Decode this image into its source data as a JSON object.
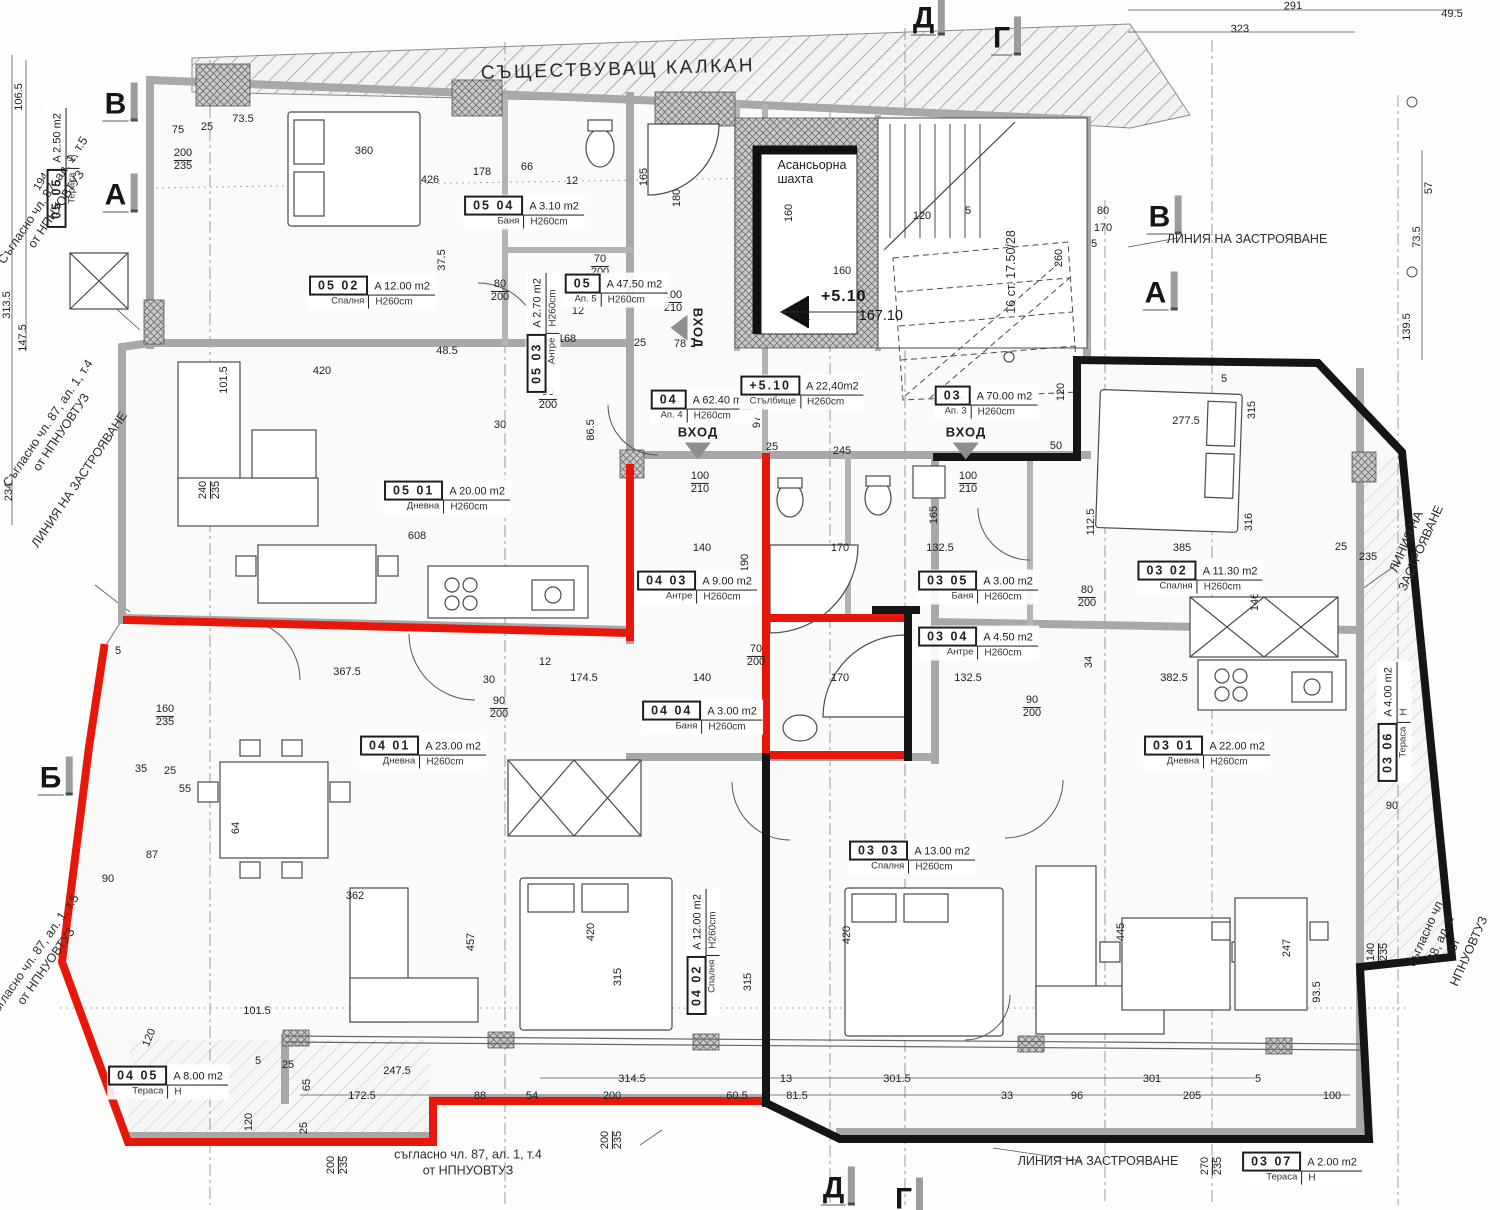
{
  "title": "СЪЩЕСТВУВАЩ КАЛКАН",
  "elevator": {
    "label": "Асансьорна\nшахта"
  },
  "level_marker": {
    "value": "+5.10",
    "kk": "КК",
    "elev": "167.10"
  },
  "colors": {
    "boundary_red": "#e8170c",
    "boundary_black": "#151515",
    "wall_gray": "#a8a8a8"
  },
  "rooms": [
    {
      "id": "05 05",
      "a": "A 2.50 m2",
      "n": "Тераса",
      "h": "Н",
      "x": 63,
      "y": 168,
      "r": -90
    },
    {
      "id": "05 02",
      "a": "A 12.00 m2",
      "n": "Спалня",
      "h": "H260cm",
      "x": 372,
      "y": 292
    },
    {
      "id": "05 04",
      "a": "A 3.10 m2",
      "n": "Баня",
      "h": "H260cm",
      "x": 524,
      "y": 212
    },
    {
      "id": "05 03",
      "a": "A 2.70 m2",
      "n": "Антре",
      "h": "H260cm",
      "x": 543,
      "y": 333,
      "r": -90
    },
    {
      "id": "05",
      "a": "A 47.50 m2",
      "n": "Ап. 5",
      "h": "H260cm",
      "x": 616,
      "y": 290
    },
    {
      "id": "05 01",
      "a": "A 20.00 m2",
      "n": "Дневна",
      "h": "H260cm",
      "x": 447,
      "y": 497
    },
    {
      "id": "04",
      "a": "A 62.40 m2",
      "n": "Ап. 4",
      "h": "H260cm",
      "x": 702,
      "y": 406
    },
    {
      "id": "+5.10",
      "a": "A 22,40m2",
      "n": "Стълбище",
      "h": "H260cm",
      "x": 802,
      "y": 392
    },
    {
      "id": "03",
      "a": "A 70.00 m2",
      "n": "Ап. 3",
      "h": "H260cm",
      "x": 986,
      "y": 402
    },
    {
      "id": "04 03",
      "a": "A 9.00 m2",
      "n": "Антре",
      "h": "H260cm",
      "x": 697,
      "y": 587
    },
    {
      "id": "03 05",
      "a": "A 3.00 m2",
      "n": "Баня",
      "h": "H260cm",
      "x": 978,
      "y": 587
    },
    {
      "id": "03 04",
      "a": "A 4.50 m2",
      "n": "Антре",
      "h": "H260cm",
      "x": 978,
      "y": 643
    },
    {
      "id": "03 02",
      "a": "A 11.30 m2",
      "n": "Спалня",
      "h": "H260cm",
      "x": 1200,
      "y": 577
    },
    {
      "id": "04 01",
      "a": "A 23.00 m2",
      "n": "Дневна",
      "h": "H260cm",
      "x": 423,
      "y": 752
    },
    {
      "id": "04 04",
      "a": "A 3.00 m2",
      "n": "Баня",
      "h": "H260cm",
      "x": 702,
      "y": 717
    },
    {
      "id": "03 01",
      "a": "A 22.00 m2",
      "n": "Дневна",
      "h": "H260cm",
      "x": 1207,
      "y": 752
    },
    {
      "id": "03 06",
      "a": "A 4.00 m2",
      "n": "Тераса",
      "h": "Н",
      "x": 1394,
      "y": 722,
      "r": -90
    },
    {
      "id": "03 03",
      "a": "A 13.00 m2",
      "n": "Спалня",
      "h": "H260cm",
      "x": 912,
      "y": 857
    },
    {
      "id": "04 02",
      "a": "A 12.00 m2",
      "n": "Спалня",
      "h": "H260cm",
      "x": 703,
      "y": 952,
      "r": -90
    },
    {
      "id": "04 05",
      "a": "A 8.00 m2",
      "n": "Тераса",
      "h": "Н",
      "x": 168,
      "y": 1082
    },
    {
      "id": "03 07",
      "a": "A 2.00 m2",
      "n": "Тераса",
      "h": "Н",
      "x": 1302,
      "y": 1168
    }
  ],
  "annotations": [
    {
      "t": "ЛИНИЯ НА ЗАСТРОЯВАНЕ",
      "x": 1247,
      "y": 240
    },
    {
      "t": "ЛИНИЯ НА ЗАСТРОЯВАНЕ",
      "x": 80,
      "y": 480,
      "r": -56
    },
    {
      "t": "ЛИНИЯ НА ЗАСТРОЯВАНЕ",
      "x": 1414,
      "y": 545,
      "r": -66
    },
    {
      "t": "ЛИНИЯ НА ЗАСТРОЯВАНЕ",
      "x": 1098,
      "y": 1162
    },
    {
      "t": "Съгласно чл. 87, ал. 1, т.5\nот НПНУОВТУЗ",
      "x": 50,
      "y": 205,
      "r": -56
    },
    {
      "t": "Съгласно чл. 87, ал. 1, т.4\nот НПНУОВТУЗ",
      "x": 55,
      "y": 428,
      "r": -56
    },
    {
      "t": "Съгласно чл. 87, ал. 1, т.5\nот НПНУОВТУЗ",
      "x": 40,
      "y": 962,
      "r": -55
    },
    {
      "t": "съгласно чл. 87, ал. 1, т.4\nот НПНУОВТУЗ",
      "x": 468,
      "y": 1163
    },
    {
      "t": "съгласно чл. 88, ал. 2\nот НПНУОВТУЗ",
      "x": 1448,
      "y": 942,
      "r": -66
    },
    {
      "t": "16 ст. 17.50/28",
      "x": 1012,
      "y": 272,
      "r": -90
    }
  ],
  "grid_markers": [
    {
      "l": "В",
      "x": 120,
      "y": 102
    },
    {
      "l": "А",
      "x": 120,
      "y": 193
    },
    {
      "l": "Б",
      "x": 55,
      "y": 776
    },
    {
      "l": "В",
      "x": 1164,
      "y": 215
    },
    {
      "l": "А",
      "x": 1160,
      "y": 291
    },
    {
      "l": "Д",
      "x": 928,
      "y": 16
    },
    {
      "l": "Г",
      "x": 1006,
      "y": 36
    },
    {
      "l": "Д",
      "x": 838,
      "y": 1186
    },
    {
      "l": "Г",
      "x": 908,
      "y": 1197
    }
  ],
  "entrances": [
    {
      "label": "ВХОД",
      "x": 698,
      "y": 442
    },
    {
      "label": "ВХОД",
      "x": 966,
      "y": 442
    },
    {
      "label": "ВХОД",
      "x": 688,
      "y": 328,
      "r": 90
    }
  ],
  "dimensions": [
    {
      "x": 1293,
      "y": 7,
      "t": "291",
      "r": -2
    },
    {
      "x": 1452,
      "y": 15,
      "t": "49.5"
    },
    {
      "x": 1240,
      "y": 30,
      "t": "323",
      "r": -2
    },
    {
      "x": 20,
      "y": 97,
      "t": "106.5",
      "r": -90
    },
    {
      "x": 8,
      "y": 305,
      "t": "313.5",
      "r": -90
    },
    {
      "x": 24,
      "y": 338,
      "t": "147.5",
      "r": -90
    },
    {
      "x": 10,
      "y": 492,
      "t": "234",
      "r": -90
    },
    {
      "x": 42,
      "y": 182,
      "t": "194",
      "r": -58
    },
    {
      "x": 1418,
      "y": 237,
      "t": "73.5",
      "r": -90
    },
    {
      "x": 1430,
      "y": 188,
      "t": "57",
      "r": -90
    },
    {
      "x": 1408,
      "y": 327,
      "t": "139.5",
      "r": -90
    },
    {
      "x": 178,
      "y": 131,
      "t": "75"
    },
    {
      "x": 207,
      "y": 128,
      "t": "25"
    },
    {
      "x": 243,
      "y": 120,
      "t": "73.5"
    },
    {
      "x": 183,
      "y": 160,
      "t": "200",
      "t2": "235"
    },
    {
      "x": 364,
      "y": 152,
      "t": "360"
    },
    {
      "x": 430,
      "y": 181,
      "t": "426"
    },
    {
      "x": 482,
      "y": 173,
      "t": "178"
    },
    {
      "x": 527,
      "y": 168,
      "t": "66"
    },
    {
      "x": 572,
      "y": 182,
      "t": "12"
    },
    {
      "x": 645,
      "y": 177,
      "t": "165",
      "r": -90
    },
    {
      "x": 678,
      "y": 198,
      "t": "180",
      "r": -90
    },
    {
      "x": 790,
      "y": 213,
      "t": "160",
      "r": -90
    },
    {
      "x": 922,
      "y": 217,
      "t": "120"
    },
    {
      "x": 968,
      "y": 212,
      "t": "5"
    },
    {
      "x": 1103,
      "y": 212,
      "t": "80"
    },
    {
      "x": 1103,
      "y": 229,
      "t": "170"
    },
    {
      "x": 1094,
      "y": 245,
      "t": "5"
    },
    {
      "x": 443,
      "y": 260,
      "t": "37.5",
      "r": -90
    },
    {
      "x": 447,
      "y": 352,
      "t": "48.5"
    },
    {
      "x": 500,
      "y": 291,
      "t": "80",
      "t2": "200"
    },
    {
      "x": 600,
      "y": 266,
      "t": "70",
      "t2": "200"
    },
    {
      "x": 673,
      "y": 302,
      "t": "100",
      "t2": "210"
    },
    {
      "x": 548,
      "y": 399,
      "t": "90",
      "t2": "200"
    },
    {
      "x": 500,
      "y": 426,
      "t": "30"
    },
    {
      "x": 592,
      "y": 430,
      "t": "86.5",
      "r": -90
    },
    {
      "x": 567,
      "y": 340,
      "t": "168"
    },
    {
      "x": 578,
      "y": 312,
      "t": "12"
    },
    {
      "x": 632,
      "y": 288,
      "t": "35",
      "r": -90
    },
    {
      "x": 640,
      "y": 344,
      "t": "25"
    },
    {
      "x": 680,
      "y": 345,
      "t": "78"
    },
    {
      "x": 700,
      "y": 483,
      "t": "100",
      "t2": "210"
    },
    {
      "x": 758,
      "y": 422,
      "t": "97",
      "r": -90
    },
    {
      "x": 842,
      "y": 272,
      "t": "160"
    },
    {
      "x": 772,
      "y": 448,
      "t": "25"
    },
    {
      "x": 842,
      "y": 452,
      "t": "245"
    },
    {
      "x": 968,
      "y": 483,
      "t": "100",
      "t2": "210"
    },
    {
      "x": 1056,
      "y": 447,
      "t": "50"
    },
    {
      "x": 1062,
      "y": 392,
      "t": "120",
      "r": -90
    },
    {
      "x": 1060,
      "y": 258,
      "t": "260",
      "r": -90
    },
    {
      "x": 1224,
      "y": 380,
      "t": "5"
    },
    {
      "x": 225,
      "y": 380,
      "t": "101.5",
      "r": -90
    },
    {
      "x": 322,
      "y": 372,
      "t": "420"
    },
    {
      "x": 210,
      "y": 490,
      "t": "240",
      "t2": "235",
      "r": -90
    },
    {
      "x": 417,
      "y": 537,
      "t": "608"
    },
    {
      "x": 347,
      "y": 673,
      "t": "367.5"
    },
    {
      "x": 489,
      "y": 681,
      "t": "30"
    },
    {
      "x": 499,
      "y": 708,
      "t": "90",
      "t2": "200"
    },
    {
      "x": 584,
      "y": 679,
      "t": "174.5"
    },
    {
      "x": 545,
      "y": 663,
      "t": "12"
    },
    {
      "x": 702,
      "y": 549,
      "t": "140"
    },
    {
      "x": 746,
      "y": 563,
      "t": "190",
      "r": -90
    },
    {
      "x": 702,
      "y": 679,
      "t": "140"
    },
    {
      "x": 840,
      "y": 549,
      "t": "170"
    },
    {
      "x": 840,
      "y": 679,
      "t": "170"
    },
    {
      "x": 756,
      "y": 656,
      "t": "70",
      "t2": "200"
    },
    {
      "x": 940,
      "y": 549,
      "t": "132.5"
    },
    {
      "x": 968,
      "y": 679,
      "t": "132.5"
    },
    {
      "x": 935,
      "y": 515,
      "t": "165",
      "r": -90
    },
    {
      "x": 1087,
      "y": 597,
      "t": "80",
      "t2": "200"
    },
    {
      "x": 1032,
      "y": 707,
      "t": "90",
      "t2": "200"
    },
    {
      "x": 1092,
      "y": 522,
      "t": "112.5",
      "r": -90
    },
    {
      "x": 1090,
      "y": 662,
      "t": "34",
      "r": -90
    },
    {
      "x": 1182,
      "y": 549,
      "t": "385"
    },
    {
      "x": 1174,
      "y": 679,
      "t": "382.5"
    },
    {
      "x": 1250,
      "y": 522,
      "t": "316",
      "r": -90
    },
    {
      "x": 1256,
      "y": 602,
      "t": "146",
      "r": -90
    },
    {
      "x": 1341,
      "y": 548,
      "t": "25"
    },
    {
      "x": 1368,
      "y": 558,
      "t": "235"
    },
    {
      "x": 1186,
      "y": 422,
      "t": "277.5"
    },
    {
      "x": 1253,
      "y": 410,
      "t": "315",
      "r": -90
    },
    {
      "x": 165,
      "y": 716,
      "t": "160",
      "t2": "235"
    },
    {
      "x": 141,
      "y": 770,
      "t": "35"
    },
    {
      "x": 170,
      "y": 772,
      "t": "25"
    },
    {
      "x": 185,
      "y": 790,
      "t": "55"
    },
    {
      "x": 152,
      "y": 856,
      "t": "87"
    },
    {
      "x": 108,
      "y": 880,
      "t": "90"
    },
    {
      "x": 237,
      "y": 828,
      "t": "64",
      "r": -90
    },
    {
      "x": 118,
      "y": 652,
      "t": "5"
    },
    {
      "x": 355,
      "y": 897,
      "t": "362"
    },
    {
      "x": 472,
      "y": 942,
      "t": "457",
      "r": -90
    },
    {
      "x": 592,
      "y": 932,
      "t": "420",
      "r": -90
    },
    {
      "x": 619,
      "y": 977,
      "t": "315",
      "r": -90
    },
    {
      "x": 749,
      "y": 982,
      "t": "315",
      "r": -90
    },
    {
      "x": 848,
      "y": 935,
      "t": "420",
      "r": -90
    },
    {
      "x": 1122,
      "y": 932,
      "t": "445",
      "r": -90
    },
    {
      "x": 257,
      "y": 1012,
      "t": "101.5"
    },
    {
      "x": 150,
      "y": 1038,
      "t": "120",
      "r": -68
    },
    {
      "x": 258,
      "y": 1062,
      "t": "5"
    },
    {
      "x": 288,
      "y": 1066,
      "t": "25"
    },
    {
      "x": 308,
      "y": 1085,
      "t": "65",
      "r": -90
    },
    {
      "x": 305,
      "y": 1128,
      "t": "25",
      "r": -90
    },
    {
      "x": 397,
      "y": 1072,
      "t": "247.5"
    },
    {
      "x": 362,
      "y": 1097,
      "t": "172.5"
    },
    {
      "x": 480,
      "y": 1097,
      "t": "88"
    },
    {
      "x": 532,
      "y": 1097,
      "t": "54"
    },
    {
      "x": 612,
      "y": 1097,
      "t": "200"
    },
    {
      "x": 737,
      "y": 1097,
      "t": "60.5"
    },
    {
      "x": 632,
      "y": 1080,
      "t": "314.5"
    },
    {
      "x": 786,
      "y": 1080,
      "t": "13"
    },
    {
      "x": 797,
      "y": 1097,
      "t": "81.5"
    },
    {
      "x": 897,
      "y": 1080,
      "t": "301.5"
    },
    {
      "x": 1007,
      "y": 1097,
      "t": "33"
    },
    {
      "x": 1077,
      "y": 1097,
      "t": "96"
    },
    {
      "x": 1192,
      "y": 1097,
      "t": "205"
    },
    {
      "x": 1152,
      "y": 1080,
      "t": "301"
    },
    {
      "x": 1332,
      "y": 1097,
      "t": "100"
    },
    {
      "x": 1258,
      "y": 1080,
      "t": "5"
    },
    {
      "x": 250,
      "y": 1122,
      "t": "120",
      "r": -90
    },
    {
      "x": 338,
      "y": 1165,
      "t": "200",
      "t2": "235",
      "r": -90
    },
    {
      "x": 612,
      "y": 1140,
      "t": "200",
      "t2": "235",
      "r": -90
    },
    {
      "x": 1212,
      "y": 1166,
      "t": "270",
      "t2": "235",
      "r": -90
    },
    {
      "x": 1288,
      "y": 948,
      "t": "247",
      "r": -90
    },
    {
      "x": 1318,
      "y": 992,
      "t": "93.5",
      "r": -90
    },
    {
      "x": 1378,
      "y": 952,
      "t": "140",
      "t2": "235",
      "r": -90
    },
    {
      "x": 1392,
      "y": 807,
      "t": "90"
    }
  ]
}
